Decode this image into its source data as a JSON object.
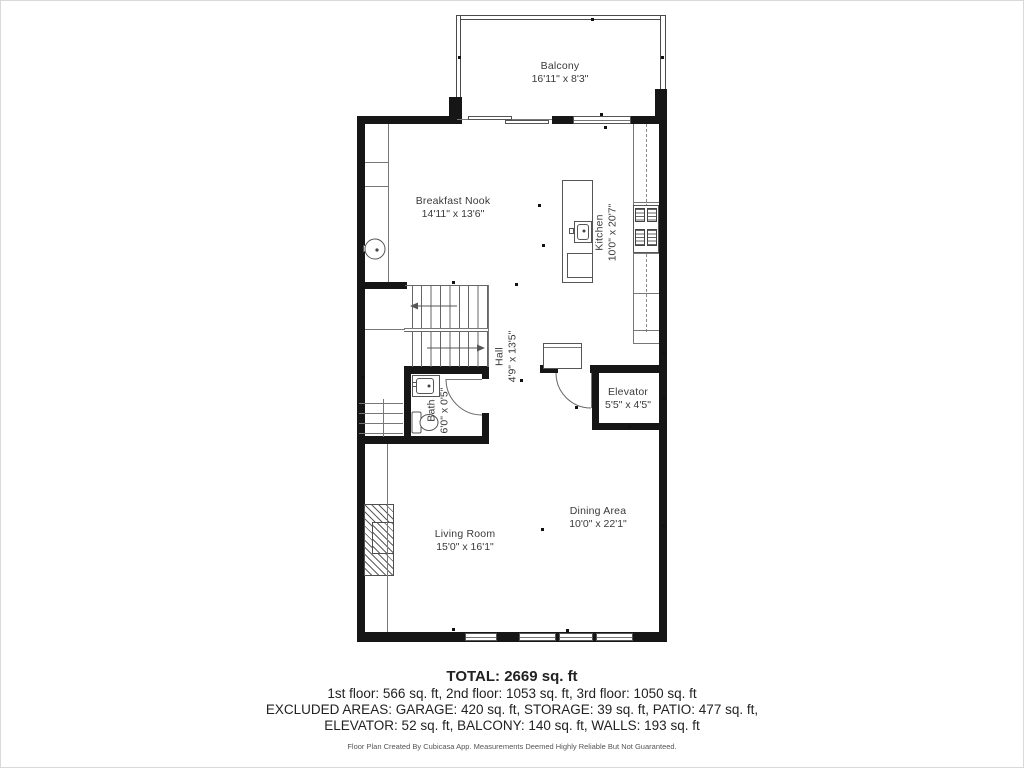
{
  "plan": {
    "rooms": {
      "balcony": {
        "name": "Balcony",
        "dims": "16'11\" x 8'3\""
      },
      "breakfast_nook": {
        "name": "Breakfast Nook",
        "dims": "14'11\" x 13'6\""
      },
      "kitchen": {
        "name": "Kitchen",
        "dims": "10'0\" x 20'7\""
      },
      "hall": {
        "name": "Hall",
        "dims": "4'9\" x 13'5\""
      },
      "bath": {
        "name": "Bath",
        "dims": "6'0\" x 0'5\""
      },
      "elevator": {
        "name": "Elevator",
        "dims": "5'5\" x 4'5\""
      },
      "living_room": {
        "name": "Living Room",
        "dims": "15'0\" x 16'1\""
      },
      "dining_area": {
        "name": "Dining Area",
        "dims": "10'0\" x 22'1\""
      }
    },
    "summary": {
      "total": "TOTAL: 2669 sq. ft",
      "floors": "1st floor: 566 sq. ft, 2nd floor: 1053 sq. ft, 3rd floor: 1050 sq. ft",
      "excluded_1": "EXCLUDED AREAS: GARAGE: 420 sq. ft, STORAGE: 39 sq. ft, PATIO: 477 sq. ft,",
      "excluded_2": "ELEVATOR: 52 sq. ft, BALCONY: 140 sq. ft, WALLS: 193 sq. ft",
      "disclaimer": "Floor Plan Created By Cubicasa App. Measurements Deemed Highly Reliable But Not Guaranteed."
    },
    "colors": {
      "wall": "#161616",
      "line": "#5a5a5a",
      "label": "#3a3a3a"
    }
  }
}
